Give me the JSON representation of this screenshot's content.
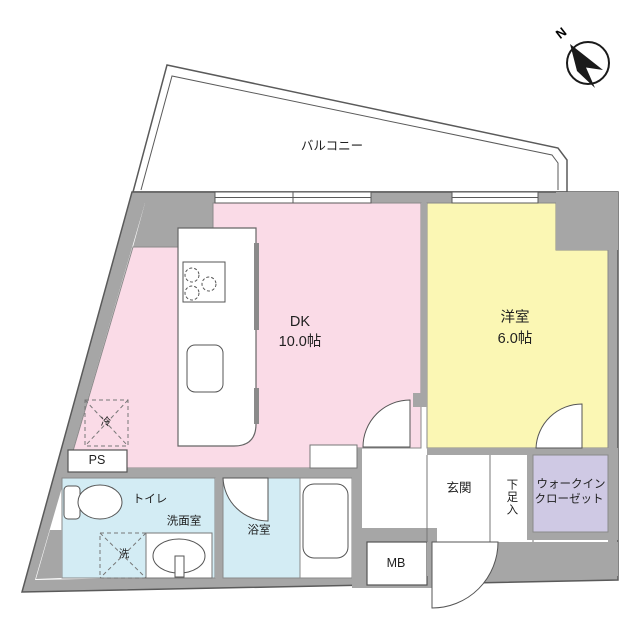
{
  "compass": {
    "label": "N"
  },
  "balcony": {
    "label": "バルコニー"
  },
  "rooms": {
    "dk": {
      "name": "DK",
      "size": "10.0帖"
    },
    "western": {
      "name": "洋室",
      "size": "6.0帖"
    },
    "toilet": {
      "label": "トイレ"
    },
    "washroom": {
      "label": "洗面室"
    },
    "bathroom": {
      "label": "浴室"
    },
    "entrance": {
      "label": "玄関"
    },
    "shoe_storage": {
      "label": "下足入"
    },
    "walk_in_closet": {
      "line1": "ウォークイン",
      "line2": "クローゼット"
    }
  },
  "fixtures": {
    "refrigerator": {
      "label": "冷"
    },
    "washer": {
      "label": "洗"
    },
    "pipe_space": {
      "label": "PS"
    },
    "meter_box": {
      "label": "MB"
    }
  },
  "colors": {
    "wall": "#a6a6a6",
    "dk": "#fadbe7",
    "western": "#fbf7b4",
    "wet": "#d3ecf4",
    "closet": "#cfc9e4",
    "line": "#555555"
  }
}
